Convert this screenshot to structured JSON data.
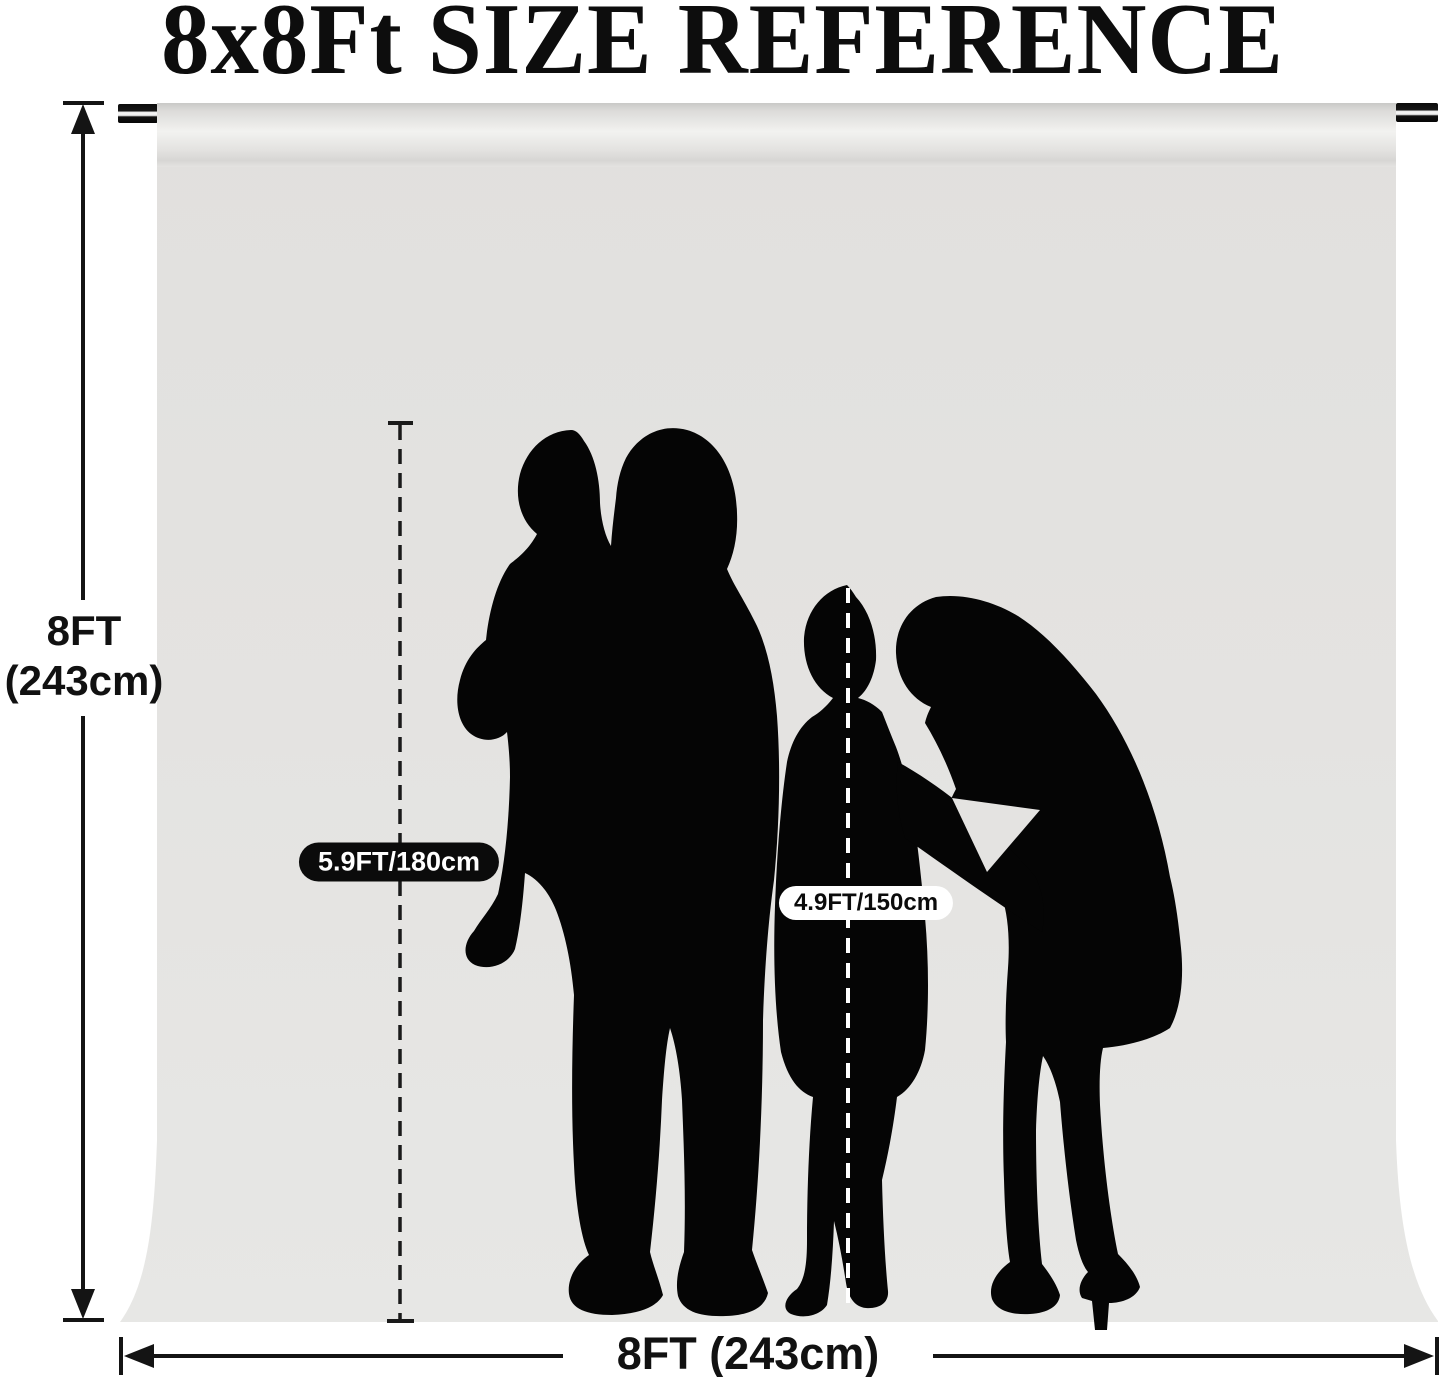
{
  "title": "8x8Ft SIZE REFERENCE",
  "backdrop": {
    "height_label_lines": [
      "8FT",
      "(243cm)"
    ],
    "width_label": "8FT (243cm)"
  },
  "figures": {
    "adult_height_label": "5.9FT/180cm",
    "child_height_label": "4.9FT/150cm"
  },
  "icons": {
    "height_arrow": "double-headed-vertical-arrow",
    "width_arrow": "double-headed-horizontal-arrow"
  },
  "colors": {
    "backdrop_fabric": "#e4e3e1",
    "silhouette": "#050505",
    "adult_pill_bg": "#0b0b0b",
    "adult_pill_text": "#ffffff",
    "child_pill_bg": "#ffffff",
    "child_pill_text": "#0b0b0b",
    "page_bg": "#ffffff"
  }
}
